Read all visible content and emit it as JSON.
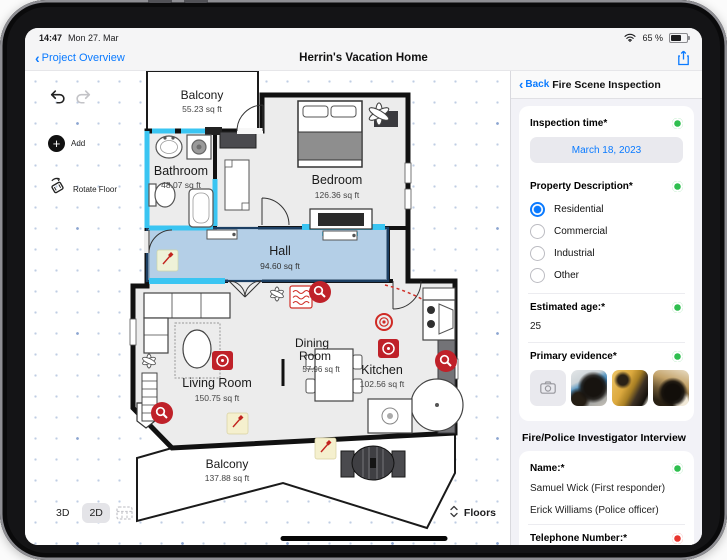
{
  "status_bar": {
    "time": "14:47",
    "date": "Mon 27. Mar",
    "battery": "65 %"
  },
  "nav_bar": {
    "back_label": "Project Overview",
    "title": "Herrin's Vacation Home"
  },
  "canvas_toolbar": {
    "add_label": "Add",
    "rotate_label": "Rotate Floor"
  },
  "view_controls": {
    "mode_3d": "3D",
    "mode_2d": "2D",
    "floors_label": "Floors"
  },
  "floorplan": {
    "rooms": {
      "balcony_top": {
        "name": "Balcony",
        "area": "55.23 sq ft"
      },
      "bathroom": {
        "name": "Bathroom",
        "area": "48.07 sq ft"
      },
      "bedroom": {
        "name": "Bedroom",
        "area": "126.36 sq ft"
      },
      "hall": {
        "name": "Hall",
        "area": "94.60 sq ft"
      },
      "living_room": {
        "name": "Living Room",
        "area": "150.75 sq ft"
      },
      "dining_room": {
        "name_line1": "Dining",
        "name_line2": "Room",
        "area": "57.96 sq ft"
      },
      "kitchen": {
        "name": "Kitchen",
        "area": "102.56 sq ft"
      },
      "balcony_bottom": {
        "name": "Balcony",
        "area": "137.88 sq ft"
      }
    }
  },
  "panel": {
    "back_label": "Back",
    "title": "Fire Scene Inspection",
    "inspection_time": {
      "label": "Inspection time*",
      "value": "March 18, 2023"
    },
    "property_description": {
      "label": "Property Description*",
      "options": [
        {
          "label": "Residential",
          "selected": true
        },
        {
          "label": "Commercial",
          "selected": false
        },
        {
          "label": "Industrial",
          "selected": false
        },
        {
          "label": "Other",
          "selected": false
        }
      ]
    },
    "estimated_age": {
      "label": "Estimated age:*",
      "value": "25"
    },
    "primary_evidence": {
      "label": "Primary evidence*",
      "photo_count": 3
    },
    "section_interview": "Fire/Police Investigator Interview",
    "name_field": {
      "label": "Name:*",
      "values": [
        "Samuel Wick (First responder)",
        "Erick Williams (Police officer)"
      ]
    },
    "telephone_field": {
      "label": "Telephone Number:*"
    }
  },
  "colors": {
    "accent_blue": "#0a7aff",
    "valid_green": "#2fbf4f",
    "invalid_red": "#e8352f",
    "selection_cyan": "#3ac5f2",
    "hall_fill": "#9ec4e4",
    "marker_red": "#bf2129"
  }
}
